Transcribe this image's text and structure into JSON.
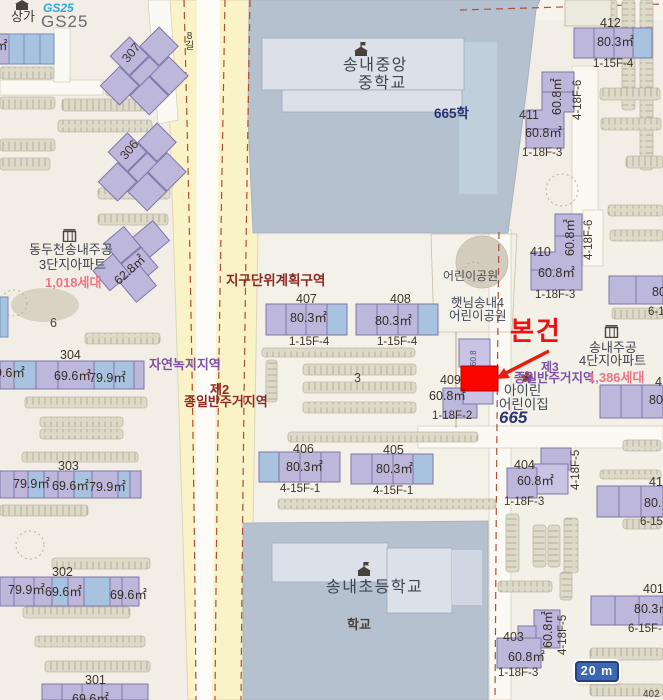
{
  "colors": {
    "subject_red": "#ec1212",
    "subject_box": "#fa0400",
    "zone_red": "#8e2723",
    "zone_purple": "#7d51a3",
    "households_pink": "#ef7585",
    "navy": "#2a3274",
    "building_purple": "#bdb7dc",
    "building_blue": "#a8c3e0",
    "school_ground": "#b5c1cf",
    "road_yellow": "#faf3c8"
  },
  "shops": {
    "sangga": "상가",
    "gs25_logo": "GS25",
    "gs25_name": "GS25"
  },
  "streets": {
    "alley8": "8길",
    "path_a": "4-18F-6",
    "path_b": "4-18F-6",
    "path_c": "4-18F-5",
    "path_d": "4-18F-5"
  },
  "zones": {
    "district": "지구단위계획구역",
    "green": "자연녹지지역",
    "res2_l1": "제2",
    "res2_l2": "종일반주거지역",
    "res3_l1": "제3",
    "res3_l2": "종일반주거지역"
  },
  "schools": {
    "middle_l1": "송내중앙",
    "middle_l2": "중학교",
    "middle_lot": "665학",
    "elem": "송내초등학교",
    "elem_lot": "학교"
  },
  "complex3": {
    "l1": "동두천송내주공",
    "l2": "3단지아파트",
    "households": "1,018세대",
    "area": "62.8㎡",
    "lot": "6"
  },
  "complex4": {
    "l1": "송내주공",
    "l2": "4단지아파트",
    "households": "1,386세대"
  },
  "parks": {
    "park": "어린이공원",
    "sun_l1": "햇님송내4",
    "sun_l2": "어린이공원",
    "daycare_l1": "아이린",
    "daycare_l2": "어린이집",
    "lot": "665"
  },
  "subject": {
    "label": "본건"
  },
  "lots": {
    "lot3": "3",
    "lot6": "6"
  },
  "scalebar": {
    "label": "20 m"
  },
  "buildings": {
    "b307": {
      "no": "307"
    },
    "b306": {
      "no": "306"
    },
    "b304": {
      "no": "304",
      "a1": "69.6㎡",
      "a2": "69.6㎡",
      "a3": "79.9㎡"
    },
    "b303": {
      "no": "303",
      "a1": "79.9㎡",
      "a2": "69.6㎡",
      "a3": "79.9㎡"
    },
    "b302": {
      "no": "302",
      "a1": "79.9㎡",
      "a2": "69.6㎡",
      "a3": "69.6㎡"
    },
    "b301": {
      "no": "301",
      "a1": "69.6㎡"
    },
    "b412": {
      "no": "412",
      "area": "80.3㎡",
      "floors": "1-15F-4"
    },
    "b411": {
      "no": "411",
      "area": "60.8㎡",
      "area_v": "60.8㎡",
      "floors": "1-18F-3"
    },
    "b410": {
      "no": "410",
      "area": "60.8㎡",
      "area_v": "60.8㎡",
      "floors": "1-18F-3"
    },
    "b409": {
      "no": "409",
      "area": "60.8㎡",
      "area_v": "60.8",
      "floors": "1-18F-2"
    },
    "b408": {
      "no": "408",
      "area": "80.3㎡",
      "floors": "1-15F-4"
    },
    "b407": {
      "no": "407",
      "area": "80.3㎡",
      "floors": "1-15F-4"
    },
    "b406": {
      "no": "406",
      "area": "80.3㎡",
      "floors": "4-15F-1"
    },
    "b405": {
      "no": "405",
      "area": "80.3㎡",
      "floors": "4-15F-1"
    },
    "b404": {
      "no": "404",
      "area": "60.8㎡",
      "floors": "1-18F-3"
    },
    "b403": {
      "no": "403",
      "area": "60.8㎡",
      "area_v": "60.8㎡",
      "floors": "1-18F-3"
    },
    "b401": {
      "no": "401",
      "area": "80.3㎡",
      "floors": "6-15F-"
    },
    "edge_top": {
      "area": "80",
      "floors": "6-1"
    },
    "edge_mid": {
      "no": "4",
      "area": "80"
    },
    "edge_low": {
      "no": "41",
      "area": "80.",
      "floors": "6-15"
    },
    "edge_bottom": {
      "no": "402"
    },
    "edge_left": {
      "area": "㎡"
    }
  }
}
